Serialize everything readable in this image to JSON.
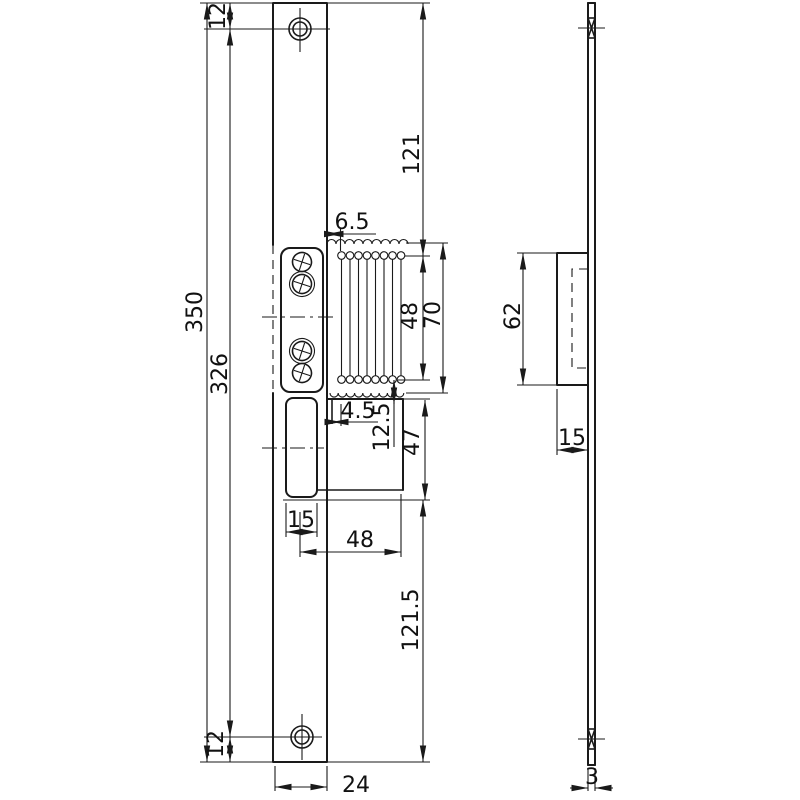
{
  "drawing": {
    "front_view": {
      "dimensions": {
        "d12_top": "12",
        "d350": "350",
        "d326": "326",
        "d121": "121",
        "d6_5": "6.5",
        "d48_vertical": "48",
        "d70": "70",
        "d4_5": "4.5",
        "d12_5": "12.5",
        "d47": "47",
        "d15_cutout": "15",
        "d48_horizontal": "48",
        "d121_5": "121.5",
        "d12_bottom": "12",
        "d24": "24"
      }
    },
    "side_view": {
      "dimensions": {
        "d62": "62",
        "d15": "15",
        "d3": "3"
      }
    }
  }
}
